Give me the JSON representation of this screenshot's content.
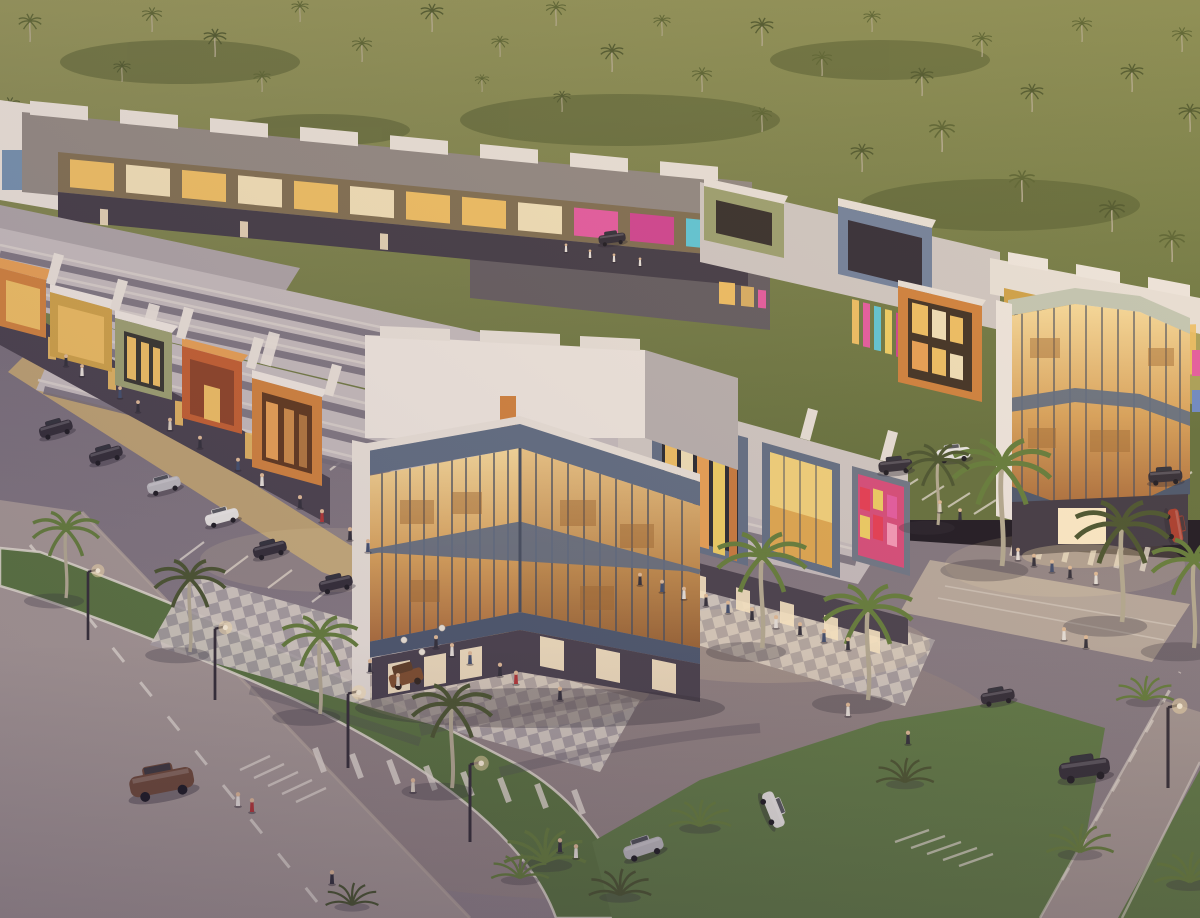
{
  "scene": {
    "description": "Aerial dusk rendering of a two-story retail plaza complex with rows of curved grey rooftops, colorful projecting storefront boxes, two glass corner buildings glowing amber, parking lots with marked stalls, palm-lined medians, lawns and pedestrians; an olive-green field scattered with palm trees stretches behind the complex",
    "time_of_day": "dusk",
    "setting": "landscaped commercial development surrounded by palm field",
    "key_features": [
      "back row of shops with khaki facade and lit multicolor windows",
      "mid row with sage and slate-blue display boxes",
      "right corner building with curved amber glass facade",
      "central corner building with slate-blue bands and two-story amber glass corner",
      "left storefront row with orange, gold, sage and red boxes",
      "checkered pedestrian plaza with cafe tables",
      "parking lots with white stall markings and crosswalks",
      "grass median with palm trees and street lamps",
      "lawns with tall royal palms",
      "parked and moving cars including a brown SUV",
      "small pedestrian figures throughout"
    ]
  },
  "palette": {
    "field_top": "#8e9156",
    "field_bottom": "#5f6e38",
    "tree_olive": "#55612f",
    "tree_dark": "#49552a",
    "palm_green": "#5f7b36",
    "palm_dark": "#44512a",
    "trunk": "#b2aa90",
    "roof_light": "#c3bcbd",
    "roof_mid": "#aaa3a6",
    "roof_rib": "#6f6875",
    "roof_ridge": "#d8d2cc",
    "roof_slab": "#8e8781",
    "wall_white": "#e9e3da",
    "wall_cream": "#efe9e1",
    "wall_shadow": "#b6b0ae",
    "wall_dusk": "#cfc9c4",
    "khaki": "#7c6c4e",
    "recess_dark": "#3c3742",
    "arcade_dark": "#423c48",
    "slate": "#5a6a80",
    "slate_deep": "#45536a",
    "slate_frame": "#5d6c82",
    "mullion": "#3e4a5c",
    "box_orange": "#d08038",
    "box_orange_deep": "#c25c2c",
    "box_orange_lit": "#e8a050",
    "box_gold": "#cfa244",
    "box_sage": "#9aa06e",
    "box_graysage": "#9aa08c",
    "box_slateblue": "#6e809c",
    "box_olivegold": "#a8a055",
    "glass_amber_top": "#f8dc9a",
    "glass_amber_mid": "#d9a257",
    "glass_amber_deep": "#a96a36",
    "glass_bright": "#ffeec8",
    "window_amber": "#f0c060",
    "window_cream": "#f2e2b8",
    "window_pink": "#e658a0",
    "window_magenta": "#d04090",
    "window_cyan": "#5ac8d8",
    "window_yellow": "#f0d060",
    "mosaic_pink": "#d84878",
    "mosaic_red": "#e83850",
    "ground_top": "#746c78",
    "ground_bottom": "#8d8286",
    "ground_dark": "#5c5560",
    "road_light": "#a39792",
    "walk_tan": "#c0a470",
    "walk_light": "#b6a99c",
    "plaza_light": "#d8d1c6",
    "plaza_gray": "#a7a1a2",
    "line_white": "#e6e0d4",
    "grass_bright": "#5a7840",
    "grass_median": "#54713a",
    "car_dark": "#2a2731",
    "car_silver": "#b9b9bd",
    "car_white": "#e8e8e4",
    "car_brown": "#6a4632",
    "car_red": "#a83828",
    "person_dark": "#2a2a34",
    "person_light": "#e8e4dc",
    "person_red": "#b03030",
    "person_navy": "#3a4a6a",
    "person_tan": "#d8d0c0",
    "skin": "#e0bc96",
    "lamp_glow": "#ffe7b0",
    "pole": "#2c2830",
    "shadow": "#2e2a34"
  }
}
